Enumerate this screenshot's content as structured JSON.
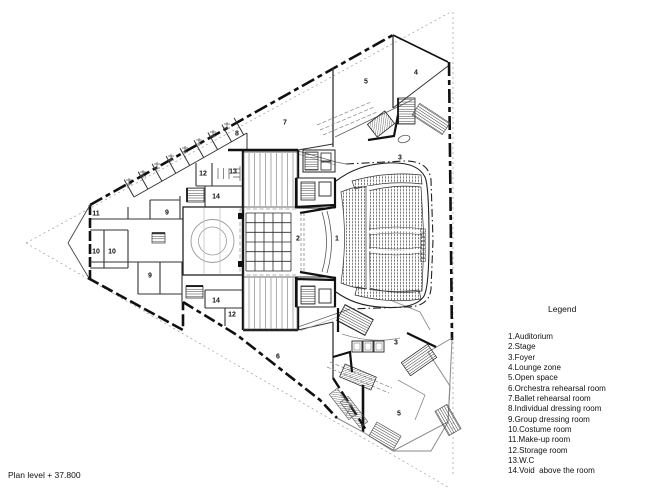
{
  "plan": {
    "level_label": "Plan level + 37.800",
    "room_markers": [
      {
        "n": "1",
        "x": 337,
        "y": 239
      },
      {
        "n": "2",
        "x": 298,
        "y": 239
      },
      {
        "n": "3",
        "x": 400,
        "y": 158
      },
      {
        "n": "3",
        "x": 396,
        "y": 343
      },
      {
        "n": "4",
        "x": 416,
        "y": 73
      },
      {
        "n": "5",
        "x": 366,
        "y": 82
      },
      {
        "n": "5",
        "x": 399,
        "y": 414
      },
      {
        "n": "6",
        "x": 278,
        "y": 357
      },
      {
        "n": "7",
        "x": 285,
        "y": 123
      },
      {
        "n": "8",
        "x": 237,
        "y": 134
      },
      {
        "n": "9",
        "x": 167,
        "y": 213
      },
      {
        "n": "9",
        "x": 150,
        "y": 276
      },
      {
        "n": "10",
        "x": 96,
        "y": 252
      },
      {
        "n": "10",
        "x": 112,
        "y": 252
      },
      {
        "n": "11",
        "x": 96,
        "y": 214
      },
      {
        "n": "12",
        "x": 203,
        "y": 174
      },
      {
        "n": "12",
        "x": 232,
        "y": 315
      },
      {
        "n": "13",
        "x": 233,
        "y": 172
      },
      {
        "n": "14",
        "x": 216,
        "y": 197
      },
      {
        "n": "14",
        "x": 216,
        "y": 301
      }
    ]
  },
  "legend": {
    "title": "Legend",
    "items": [
      "1.Auditorium",
      "2.Stage",
      "3.Foyer",
      "4.Lounge zone",
      "5.Open space",
      "6.Orchestra rehearsal room",
      "7.Ballet rehearsal room",
      "8.Individual dressing room",
      "9.Group dressing room",
      "10.Costume room",
      "11.Make-up room",
      "12.Storage room",
      "13.W.C",
      "14.Void  above the room"
    ]
  },
  "colors": {
    "ink": "#1a1a1a",
    "mid": "#555555",
    "light": "#999999",
    "bg": "#ffffff"
  }
}
